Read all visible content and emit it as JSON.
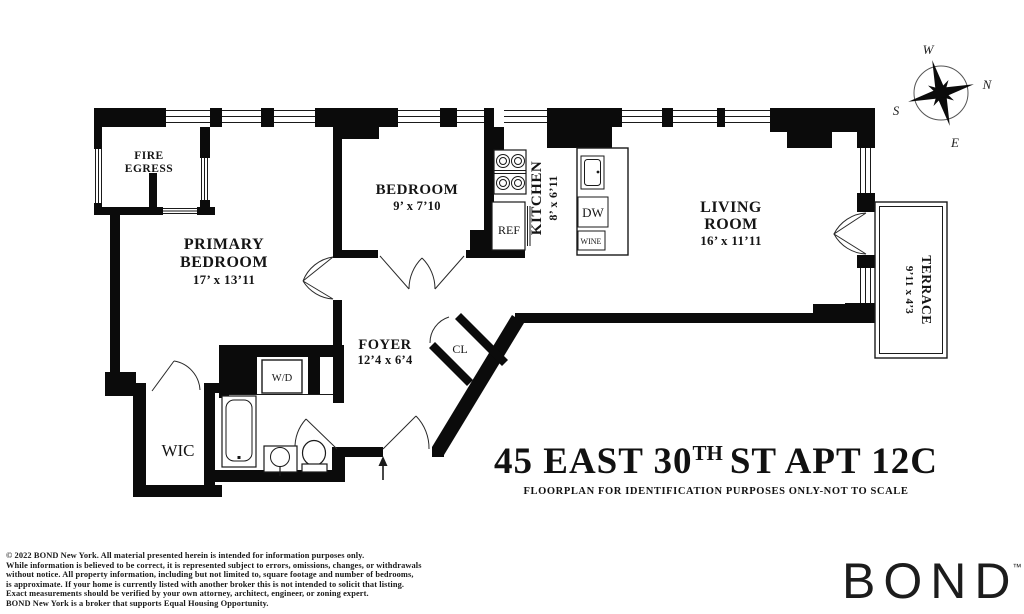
{
  "colors": {
    "ink": "#0b0b0b",
    "paper": "#ffffff"
  },
  "plan": {
    "rooms": {
      "fire_egress": {
        "line1": "FIRE",
        "line2": "EGRESS"
      },
      "primary_bedroom": {
        "line1": "PRIMARY",
        "line2": "BEDROOM",
        "dims": "17’ x 13’11"
      },
      "bedroom": {
        "name": "BEDROOM",
        "dims": "9’ x 7’10"
      },
      "kitchen": {
        "name": "KITCHEN",
        "dims": "8’ x 6’11"
      },
      "living_room": {
        "line1": "LIVING",
        "line2": "ROOM",
        "dims": "16’ x 11’11"
      },
      "terrace": {
        "name": "TERRACE",
        "dims": "9’11 x 4’3"
      },
      "foyer": {
        "name": "FOYER",
        "dims": "12’4 x 6’4"
      },
      "closet": {
        "name": "CL"
      },
      "wic": {
        "name": "WIC"
      }
    },
    "fixtures": {
      "washer_dryer": "W/D",
      "refrigerator": "REF",
      "dishwasher": "DW",
      "wine": "WINE"
    },
    "compass": {
      "n": "N",
      "s": "S",
      "e": "E",
      "w": "W"
    }
  },
  "title": {
    "prefix": "45 EAST 30",
    "superscript": "TH",
    "suffix": "ST APT 12C",
    "subtitle": "FLOORPLAN FOR IDENTIFICATION PURPOSES ONLY-NOT TO SCALE"
  },
  "footer": {
    "disclaimer_lines": [
      "© 2022 BOND New York. All material presented herein is intended for information purposes only.",
      "While information is believed to be correct, it is represented subject to errors, omissions, changes, or withdrawals",
      "without notice. All property information, including but not limited to, square footage and number of bedrooms,",
      "is approximate. If your home is currently listed with another broker this is not intended to solicit that listing.",
      "Exact measurements should be verified by your own attorney, architect, engineer, or zoning expert.",
      "BOND New York is a broker that supports Equal Housing Opportunity."
    ],
    "brand": "BOND",
    "brand_tm": "™"
  }
}
